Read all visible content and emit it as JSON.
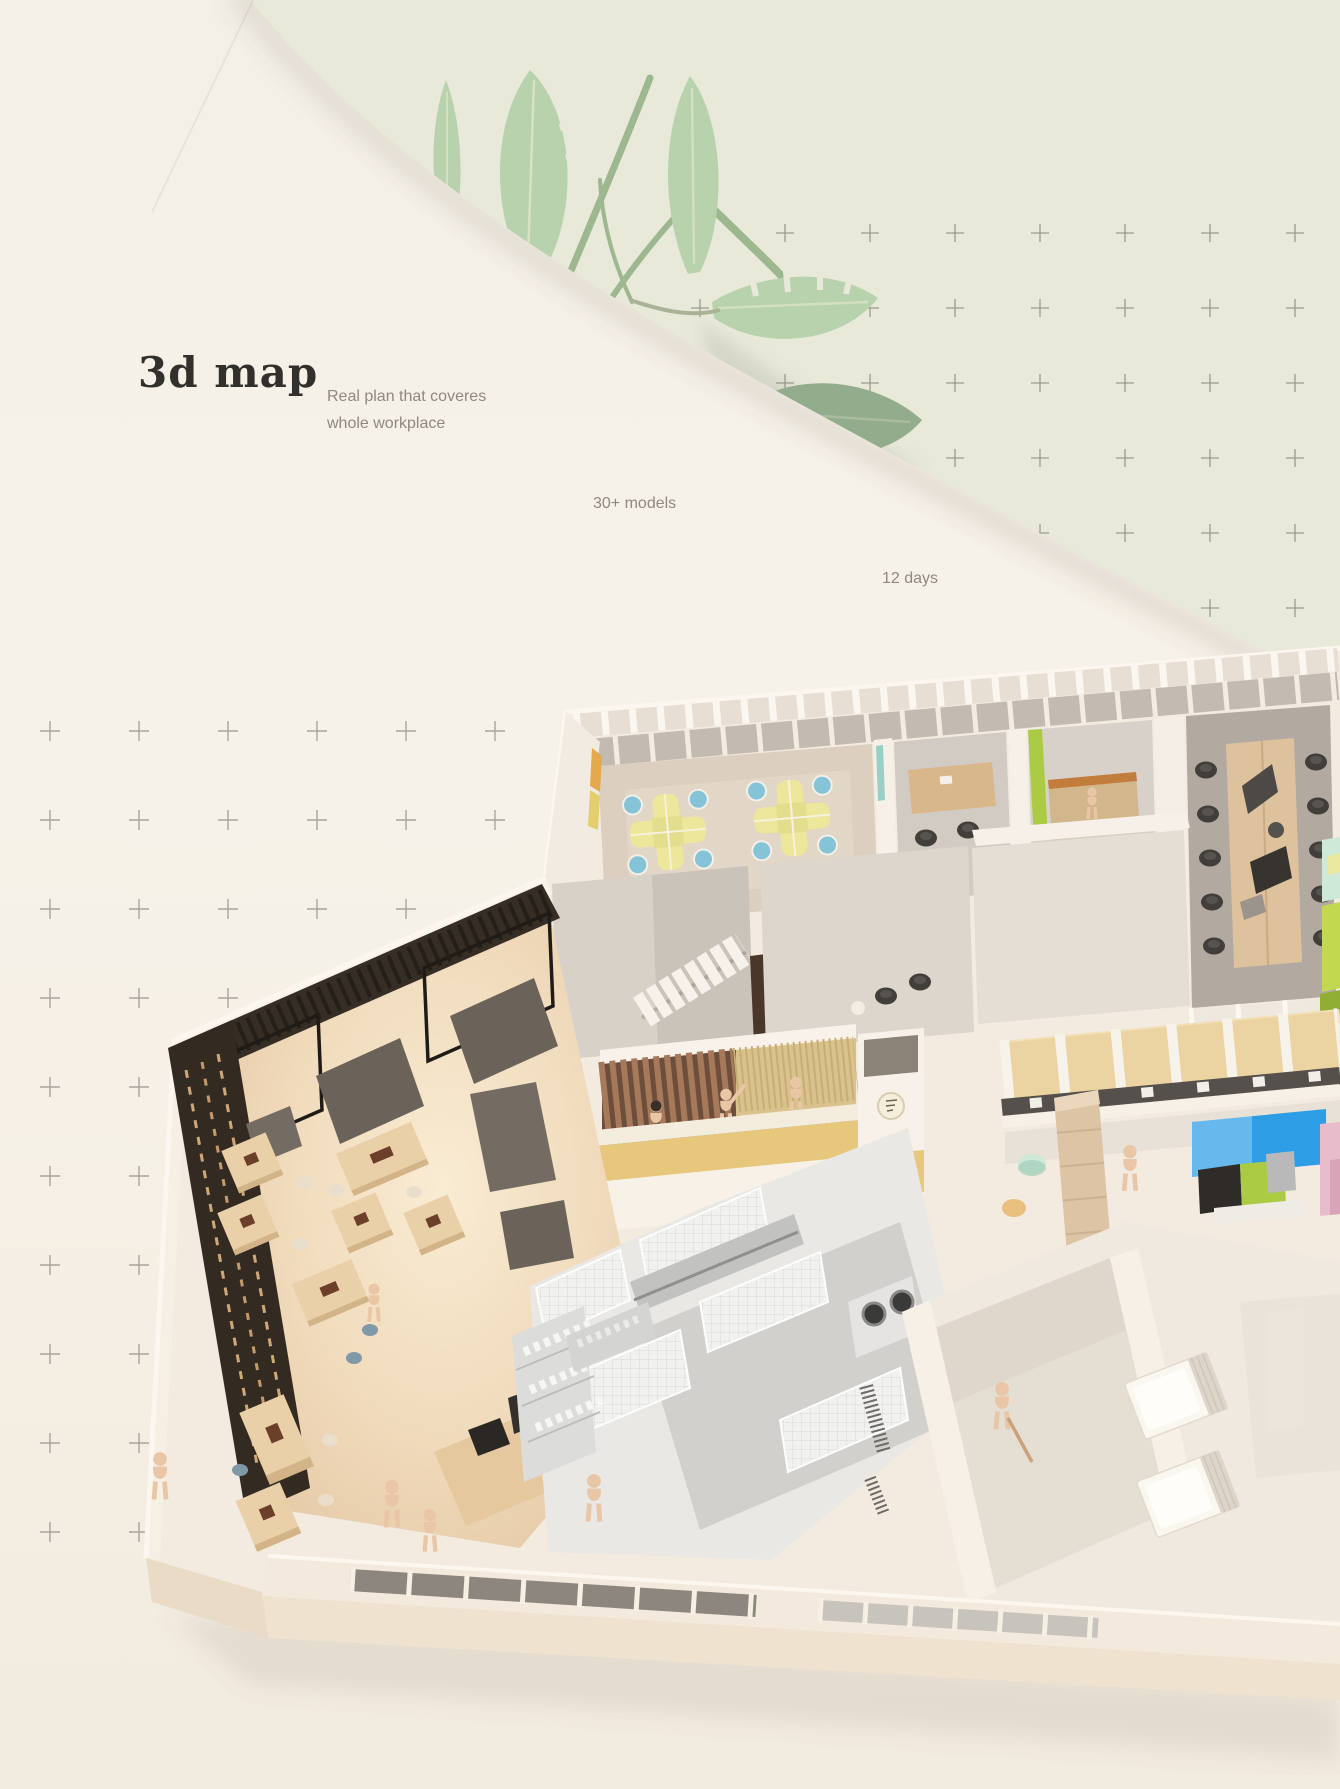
{
  "hero": {
    "title": "3d map",
    "subtitle_line1": "Real plan that coveres",
    "subtitle_line2": "whole workplace",
    "stat_models": "30+ models",
    "stat_days": "12 days"
  },
  "decor": {
    "plus_grid_right": "plus-pattern on sage background, top right",
    "plus_grid_left": "plus-pattern on cream background, left of floor plan",
    "plants": "tropical banana leaves behind curved cream shape"
  },
  "floorplan": {
    "areas": [
      "open-office",
      "private-office",
      "green-accent-office",
      "conference-room",
      "lounge-sofas",
      "staircase",
      "waiting-area",
      "reception-desk",
      "logo-pillar",
      "wc-booth-row",
      "beige-sofa-corner",
      "media-room",
      "pink-room",
      "restaurant-cafe",
      "kitchen",
      "utility-rooms",
      "bedroom-units",
      "front-window-wall"
    ]
  },
  "colors": {
    "background_sage": "#e9e9da",
    "background_cream": "#f5f0e7",
    "title_text": "#32302c",
    "body_text": "#8e8880",
    "plus_right": "#9a9a90",
    "plus_left": "#a9a49d",
    "leaf_green": "#b9d2ae",
    "leaf_olive": "#9db78f",
    "leaf_dark": "#93ac8c",
    "accent_lime": "#accb44",
    "accent_lime_sofa": "#c2d84e",
    "accent_mint": "#cfe9d8",
    "accent_blue_chair": "#85c3d6",
    "accent_desk_yellow": "#ece79b",
    "accent_gold": "#e7c77c",
    "accent_tan_booth": "#ecd3a2",
    "accent_blue_wall": "#2d9de6",
    "accent_pink": "#e9bccb",
    "beige_sofa": "#dcc4a5",
    "wood_table": "#ead0a8",
    "wood_dark_wall": "#362d25",
    "mannequin_skin": "#e9c6a6",
    "platform_cream": "#f3ebdf"
  }
}
